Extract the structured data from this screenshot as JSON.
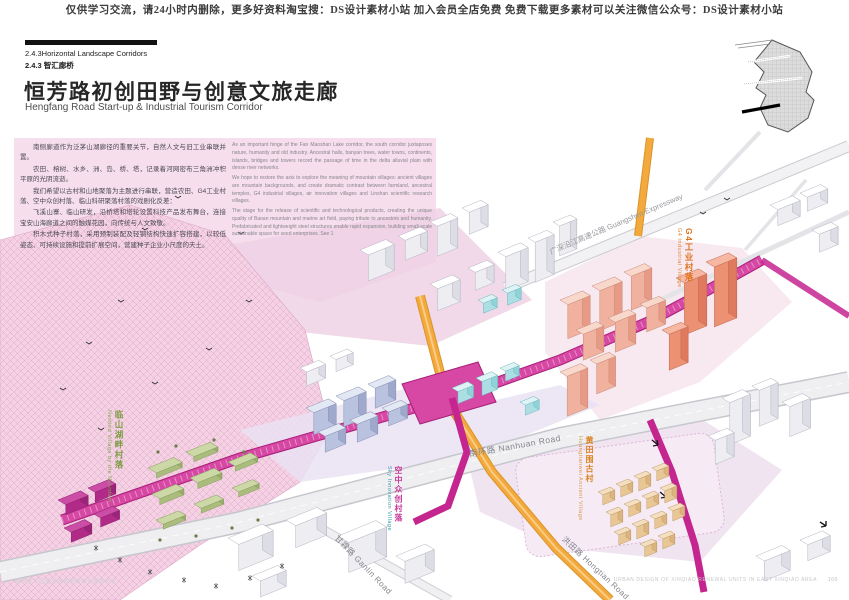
{
  "header": {
    "notice": "仅供学习交流，请24小时内删除，更多好资料淘宝搜：DS设计素材小站 加入会员全店免费 免费下载更多素材可以关注微信公众号：DS设计素材小站"
  },
  "section": {
    "code_en": "2.4.3Horizontal Landscape Corridors",
    "code_zh": "2.4.3 智汇廊桥"
  },
  "title": {
    "zh": "恒芳路初创田野与创意文旅走廊",
    "en": "Hengfang Road Start-up & Industrial Tourism Corridor"
  },
  "intro_zh": {
    "p1": "南侧廊道作为泛茅山湖廊径的重要关节，自然人文与旧工业串联并置。",
    "p2": "农田、榕树、水乡、洲、岛、桥、塔，记录着河网密布三角洲冲积平原的光阴流逝。",
    "p3": "我们希望以古村和山地聚落为主题进行串联，营造农田、G4工业村落、空中众创村落、临山科研聚落村落的戏剧化反差：",
    "p4": "飞溪山寨、临山研发，沿桥塔和塔轮设置科技产品发布舞台，连接宝安山海廊道之间的触媒花园，向传统与人文致敬。",
    "p5": "积木式种子村落，采用预制装配及轻钢结构快速扩容搭建，以较低姿态、可持续设施和提前扩展空间，营建种子企业小尺度的天土。"
  },
  "intro_en": {
    "p1": "As an important hinge of the Fan Maoshan Lake corridor, the south corridor juxtaposes nature, humanity and old industry. Ancestral halls, banyan trees, water towns, continents, islands, bridges and towers record the passage of time in the delta alluvial plain with dense river networks.",
    "p2": "We hope to restore the axis to explore the meaning of mountain villages: ancient villages are mountain backgrounds, and create dramatic contrast between farmland, ancestral temples, G4 industrial villages, air innovation villages and Linshan scientific research villages.",
    "p3": "The stage for the release of scientific and technological products, creating the unique quality of Baoan mountain and marine art field, paying tribute to ancestors and humanity. Prefabricated and lightweight steel structures enable rapid expansion, building small-scale sustainable space for seed enterprises. See 1"
  },
  "map_labels": {
    "expressway": {
      "zh": "广深沿江高速公路",
      "en": "Guangshen Expressway"
    },
    "g4_village": {
      "zh": "G4工业村落",
      "en": "G4 Industrial Village"
    },
    "sky_village": {
      "zh": "空中众创村落",
      "en": "Sky Innovation Village"
    },
    "huangtian_village": {
      "zh": "黄田围古村",
      "en": "Huangtianwei Ancient Village"
    },
    "mountain_village": {
      "zh": "临山湖畔村落",
      "en": "Nestled Village by the Mountain"
    },
    "nanhuan_road": {
      "zh": "南环路",
      "en": "Nanhuan Road"
    },
    "ganlin_road": {
      "zh": "甘霖路",
      "en": "Ganlin Road"
    },
    "hongtian_road": {
      "zh": "洪田路",
      "en": "Hongtian Road"
    }
  },
  "footer": {
    "left": "新桥东片区重点城市更新单元城市设计",
    "right": "URBAN DESIGN OF XINQIAO RENEWAL UNITS IN EAST XINQIAO AREA",
    "page": "100"
  },
  "colors": {
    "corridor_magenta": "#c4258f",
    "road_orange": "#f2a53a",
    "tower_salmon": "#ef8d72",
    "village_green": "#9db36a",
    "hatch_pink": "#f4d2e4"
  }
}
